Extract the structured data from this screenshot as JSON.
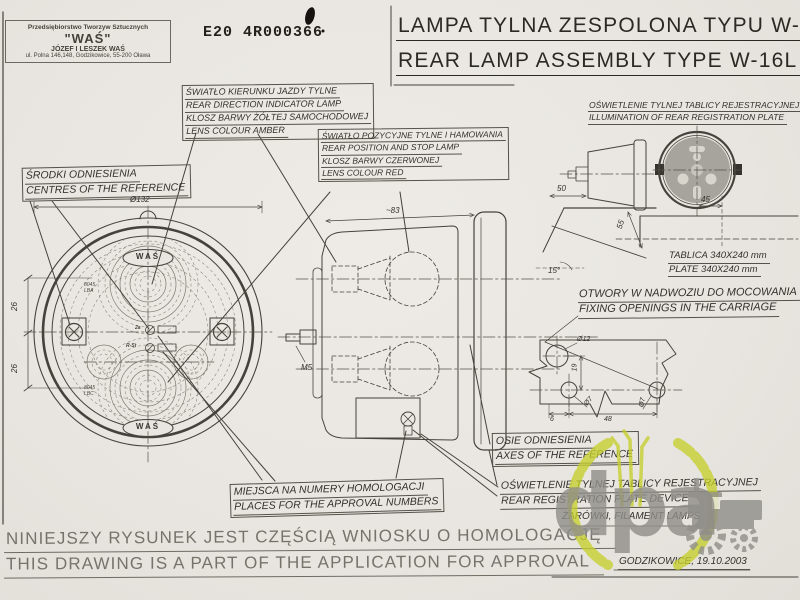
{
  "sheet": {
    "paper_color": "#e9e6e1",
    "ink_color": "#45423c",
    "watermark_green": "#c6cf2c",
    "watermark_gray": "#908e89"
  },
  "company": {
    "line1": "Przedsiębiorstwo Tworzyw Sztucznych",
    "line2": "\"WAŚ\"",
    "line3": "JÓZEF I LESZEK WAŚ",
    "line4": "ul. Polna 146,148, Godzikowice, 55-200 Oława"
  },
  "approval_mark": "E20  4R000366",
  "title": {
    "pl": "LAMPA TYLNA ZESPOLONA TYPU W-16L",
    "en": "REAR LAMP ASSEMBLY TYPE W-16L"
  },
  "labels": {
    "indicator": {
      "pl": "ŚWIATŁO KIERUNKU JAZDY TYLNE",
      "en": "REAR DIRECTION INDICATOR LAMP",
      "pl2": "KLOSZ BARWY ŻÓŁTEJ SAMOCHODOWEJ",
      "en2": "LENS COLOUR AMBER"
    },
    "position": {
      "pl": "ŚWIATŁO POZYCYJNE TYLNE I HAMOWANIA",
      "en": "REAR POSITION AND STOP LAMP",
      "pl2": "KLOSZ BARWY CZERWONEJ",
      "en2": "LENS COLOUR RED"
    },
    "centres": {
      "pl": "ŚRODKI ODNIESIENIA",
      "en": "CENTRES OF THE REFERENCE"
    },
    "illumination": {
      "pl": "OŚWIETLENIE TYLNEJ TABLICY REJESTRACYJNEJ",
      "en": "ILLUMINATION OF REAR REGISTRATION PLATE"
    },
    "plate": {
      "pl": "TABLICA 340X240 mm",
      "en": "PLATE 340X240 mm"
    },
    "fixing": {
      "pl": "OTWORY W NADWOZIU DO MOCOWANIA",
      "en": "FIXING OPENINGS IN THE CARRIAGE"
    },
    "approval_places": {
      "pl": "MIEJSCA NA NUMERY HOMOLOGACJI",
      "en": "PLACES FOR THE APPROVAL NUMBERS"
    },
    "axes": {
      "pl": "OSIE ODNIESIENIA",
      "en": "AXES OF THE REFERENCE"
    },
    "reg_device": {
      "pl": "OŚWIETLENIE TYLNEJ TABLICY REJESTRACYJNEJ",
      "en": "REAR REGISTRATION PLATE DEVICE"
    },
    "bulbs": "ŻARÓWKI, FILAMENT LAMPS",
    "place_date": "GODZIKOWICE, 19.10.2003"
  },
  "footer": {
    "pl": "NINIEJSZY RYSUNEK JEST CZĘŚCIĄ WNIOSKU O HOMOLOGACJĘ",
    "en": "THIS DRAWING IS A PART OF THE APPLICATION FOR APPROVAL"
  },
  "dims": {
    "lamp_diameter": "Ø132",
    "left_top": "26",
    "left_bottom": "26",
    "side_width": "~83",
    "stud": "M5",
    "reg_offset": "50",
    "reg_height": "55",
    "reg_width": "45",
    "plate_angle": "15°",
    "hole_big": "Ø12",
    "hole_small_left": "Ø7",
    "hole_small_right": "Ø7",
    "hole_spacing_v": "19",
    "hole_offset": "6",
    "hole_spacing_h": "48"
  },
  "markings": {
    "was_top": "WAŚ",
    "was_bottom": "WAŚ",
    "code_top1": "8045",
    "code_top2": "LBA",
    "code_bot1": "8045",
    "code_bot2": "LBC",
    "sym1": "2a",
    "sym2": "R-St"
  },
  "watermark": {
    "text": "dpa"
  }
}
